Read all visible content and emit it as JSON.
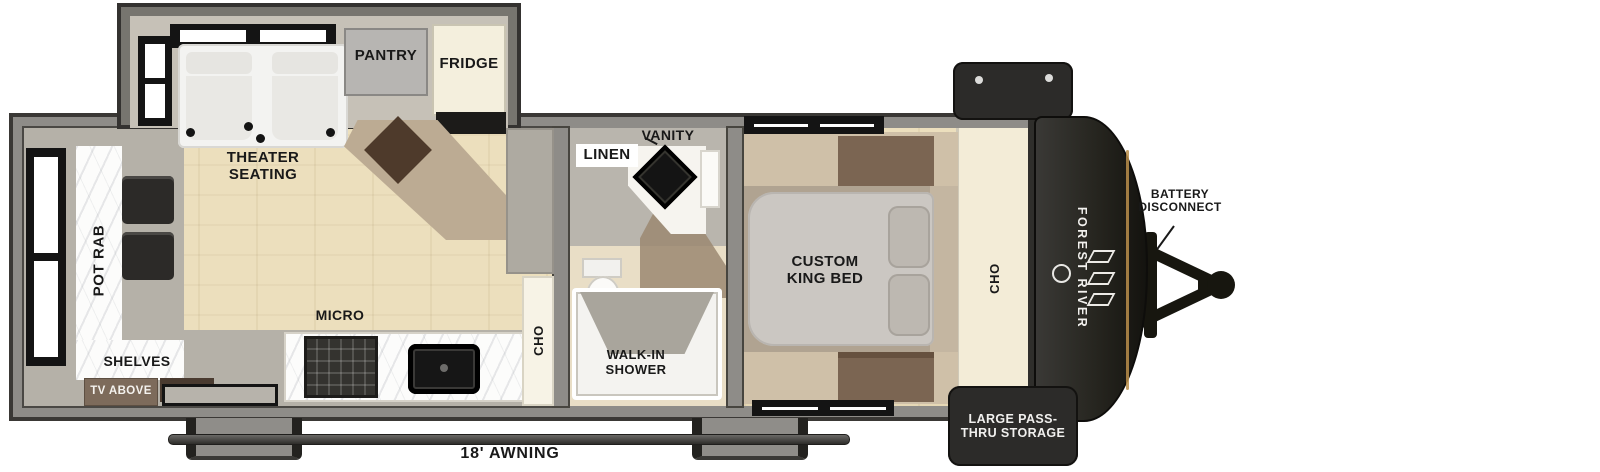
{
  "floorplan": {
    "labels": {
      "theater_seating": "THEATER SEATING",
      "pantry": "PANTRY",
      "fridge": "FRIDGE",
      "bar_top": "BAR TOP",
      "shelves": "SHELVES",
      "tv_above": "TV ABOVE",
      "micro": "MICRO",
      "ohc_kitchen": "OHC",
      "linen": "LINEN",
      "vanity": "VANITY",
      "walk_in_shower": "WALK-IN SHOWER",
      "custom_king_bed": "CUSTOM KING BED",
      "ohc_bedroom": "OHC",
      "battery_disconnect": "BATTERY DISCONNECT",
      "brand": "FOREST RIVER",
      "pass_thru_storage": "LARGE PASS-THRU STORAGE",
      "awning_length": "18' AWNING"
    },
    "colors": {
      "wall": "#8e8c88",
      "wall_edge": "#3a3835",
      "floor_wood": "#ecdfbd",
      "floor_gray": "#b5b1a8",
      "cap": "#26251f",
      "accent_gold": "#b98e4a",
      "label": "#191919",
      "cream": "#f3ecd7"
    }
  }
}
